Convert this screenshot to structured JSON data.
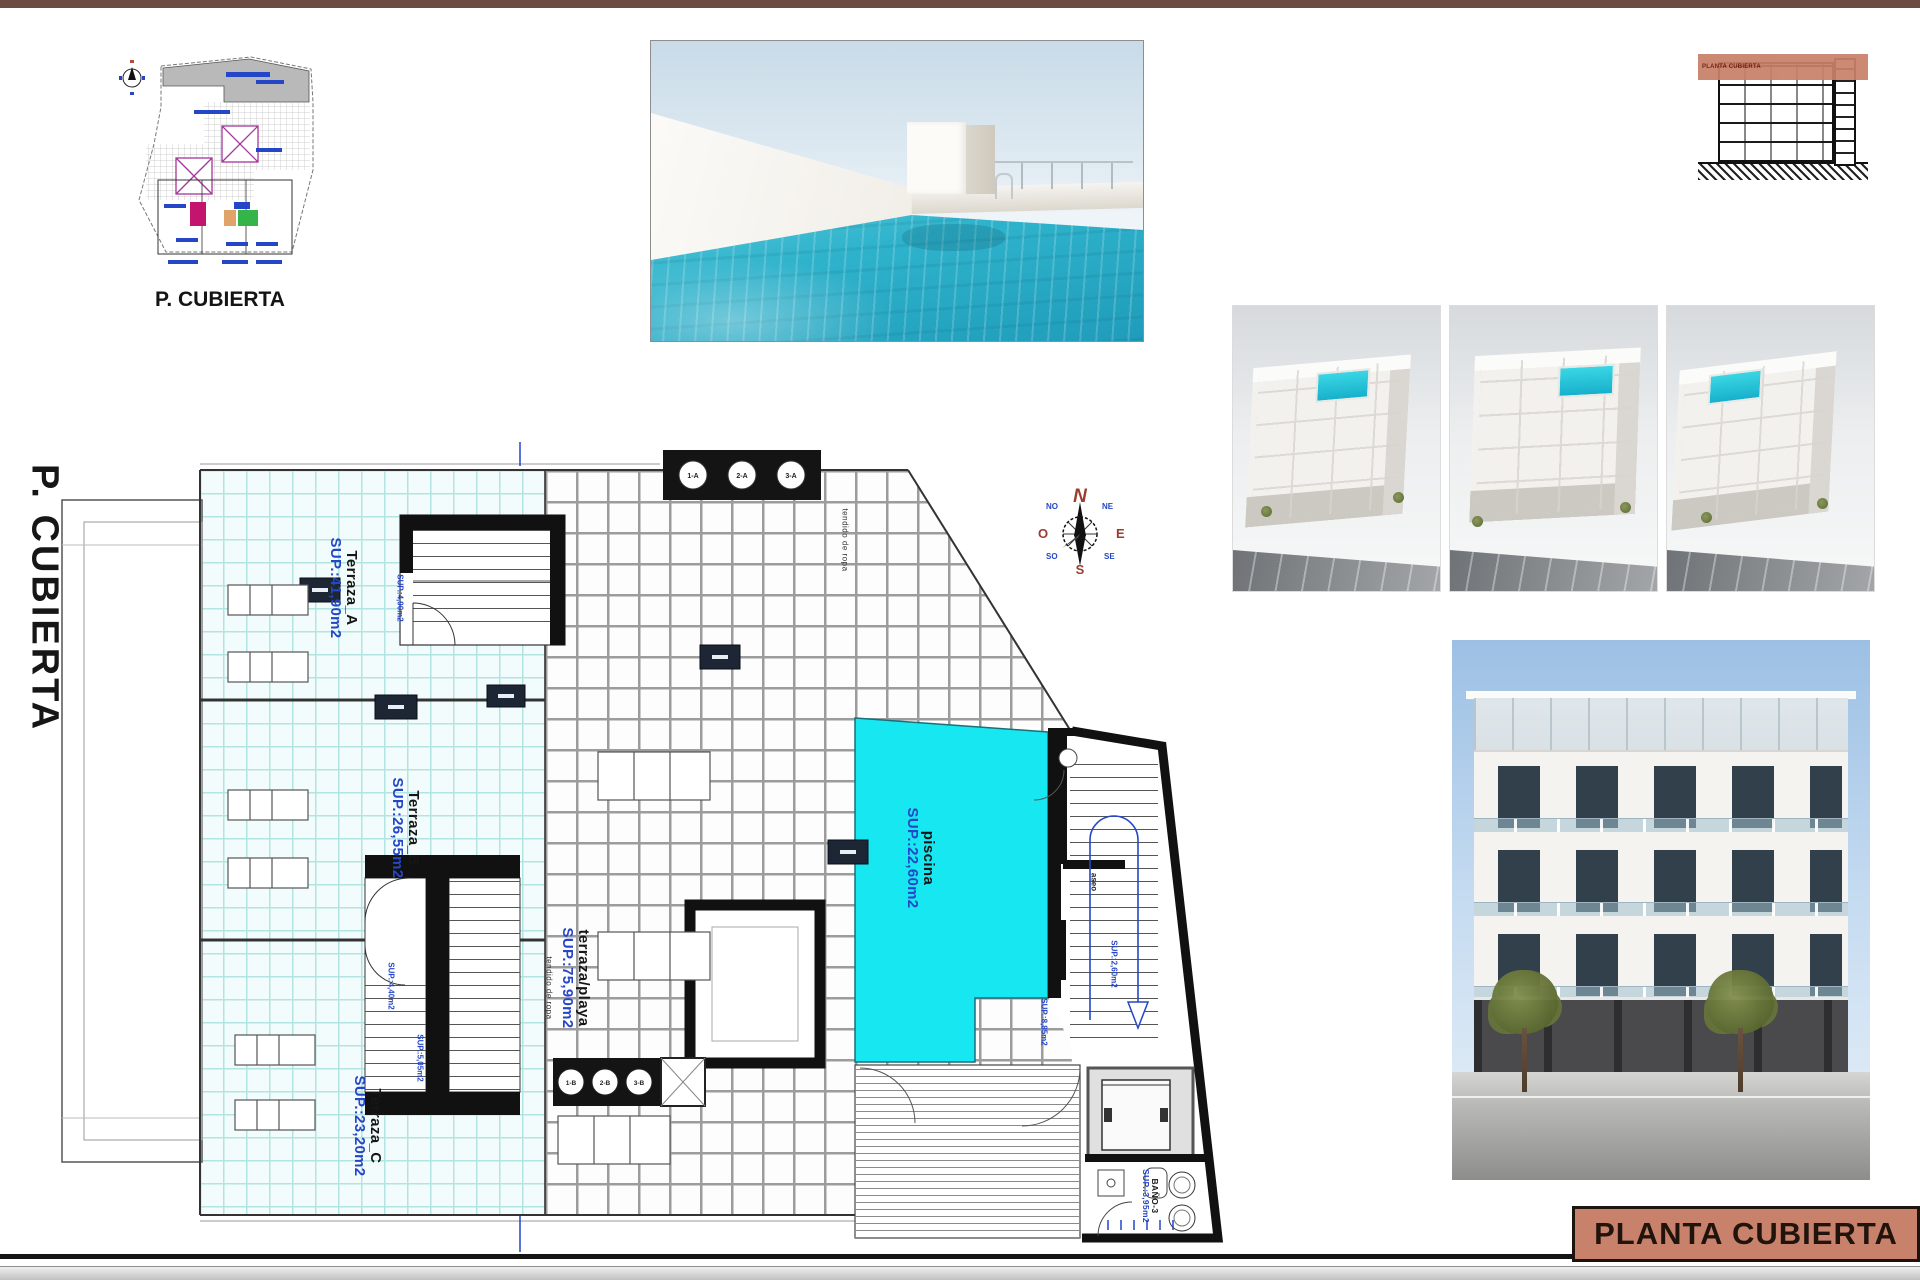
{
  "titles": {
    "sheet_title": "PLANTA CUBIERTA",
    "side_label": "P. CUBIERTA",
    "siteplan_caption": "P. CUBIERTA",
    "section_label": "PLANTA CUBIERTA"
  },
  "plan": {
    "terrazaA_name": "Terraza_A",
    "terrazaA_sup": "SUP.:41,90m2",
    "terrazaB_name": "Terraza_B",
    "terrazaB_sup": "SUP.:26,55m2",
    "terrazaC_name": "Terraza_C",
    "terrazaC_sup": "SUP.:23,20m2",
    "playa_name": "terraza/playa",
    "playa_sup": "SUP.:75,90m2",
    "piscina_name": "piscina",
    "piscina_sup": "SUP.:22,60m2",
    "bano_name": "BAÑO-3",
    "bano_sup": "SUP.:3,95m2",
    "aseo_name": "aseo",
    "aseo_sup": "SUP.:2,60m2",
    "stair1_sup": "SUP.:4,90m2",
    "stair2_sup": "SUP.:4,40m2",
    "stair3_sup": "SUP.:5,05m2",
    "core_sup": "SUP.:8,85m2",
    "laundry_note_1": "tendido de ropa",
    "laundry_note_2": "tendido de ropa",
    "vents_top": [
      "1-A",
      "2-A",
      "3-A"
    ],
    "vents_bottom": [
      "1-B",
      "2-B",
      "3-B"
    ]
  },
  "compass": {
    "n": "N",
    "s": "S",
    "e": "E",
    "w": "O",
    "ne": "NE",
    "nw": "NO",
    "se": "SE",
    "sw": "SO"
  },
  "colors": {
    "title_salmon": "#c8816a",
    "top_bar_brown": "#6d4b42",
    "pool_cyan": "#17e7f1",
    "cad_blue": "#2546c6",
    "terrace_tile_cyan": "#b2e4e1"
  }
}
